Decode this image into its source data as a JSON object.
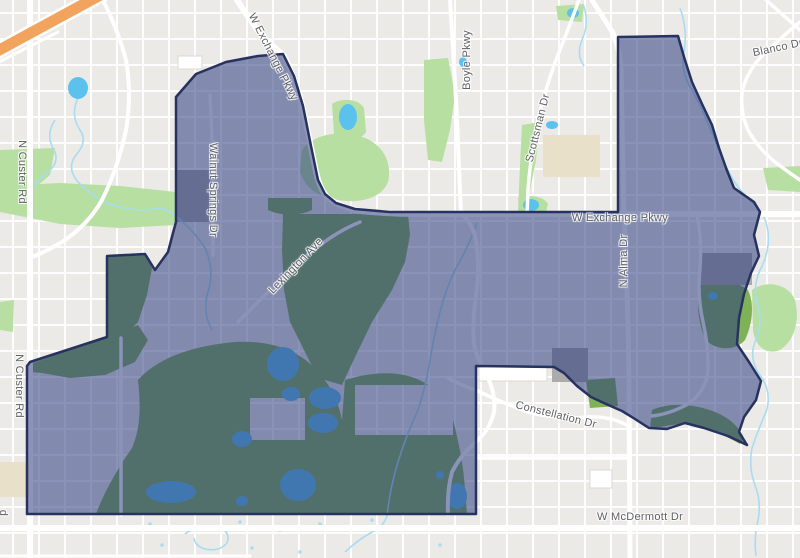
{
  "map": {
    "description": "Street map with a highlighted attendance-zone style district polygon",
    "colors": {
      "background": "#ECEAE6",
      "road": "#FFFFFF",
      "park_green": "#B7DFA1",
      "golf_green": "#7FB257",
      "water_blue": "#5BC2EE",
      "creek_blue": "#A8DCF2",
      "school_tan": "#E8E0C9",
      "building_gray": "#ABABAB",
      "highway_orange": "#F2A45F",
      "district_fill": "rgba(43,58,126,0.55)",
      "district_border": "#27325F",
      "label_text": "#5E6166"
    },
    "labels": [
      {
        "id": "w-exchange-pkwy-diagonal",
        "text": "W Exchange Pkwy",
        "x": 273,
        "y": 57,
        "rotation": 63
      },
      {
        "id": "boyle-pkwy",
        "text": "Boyle Pkwy",
        "x": 467,
        "y": 60,
        "rotation": -90
      },
      {
        "id": "scottsman-dr",
        "text": "Scottsman Dr",
        "x": 538,
        "y": 128,
        "rotation": -76
      },
      {
        "id": "blanco-dr",
        "text": "Blanco Dr",
        "x": 778,
        "y": 48,
        "rotation": -12
      },
      {
        "id": "n-custer-rd-north",
        "text": "N Custer Rd",
        "x": 22,
        "y": 172,
        "rotation": 90
      },
      {
        "id": "walnut-springs-dr",
        "text": "Walnut Springs Dr",
        "x": 213,
        "y": 190,
        "rotation": 90
      },
      {
        "id": "lexington-ave",
        "text": "Lexington Ave",
        "x": 296,
        "y": 266,
        "rotation": -46
      },
      {
        "id": "w-exchange-pkwy-horizontal",
        "text": "W Exchange Pkwy",
        "x": 620,
        "y": 218,
        "rotation": 0
      },
      {
        "id": "n-alma-dr",
        "text": "N Alma Dr",
        "x": 624,
        "y": 261,
        "rotation": -90
      },
      {
        "id": "n-custer-rd-south",
        "text": "N Custer Rd",
        "x": 19,
        "y": 386,
        "rotation": 90
      },
      {
        "id": "n-custer-rd-partial",
        "text": "d",
        "x": 3,
        "y": 513,
        "rotation": 90
      },
      {
        "id": "constellation-dr",
        "text": "Constellation Dr",
        "x": 556,
        "y": 415,
        "rotation": 14
      },
      {
        "id": "w-mcdermott-dr",
        "text": "W McDermott Dr",
        "x": 640,
        "y": 517,
        "rotation": 0
      }
    ]
  }
}
